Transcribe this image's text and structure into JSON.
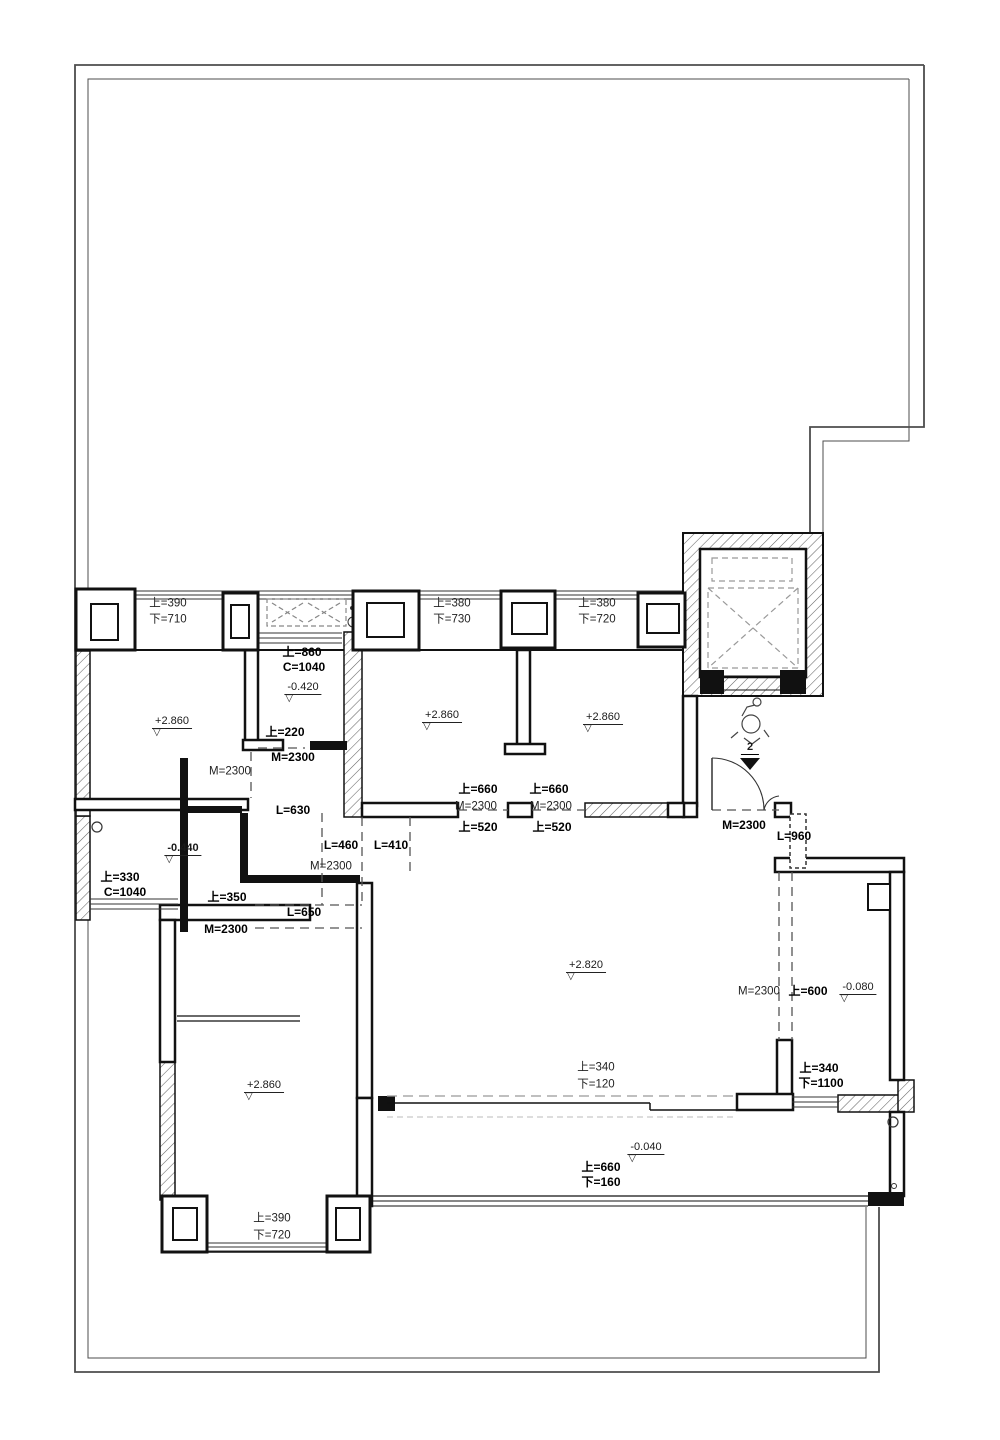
{
  "title": "apartment-floor-plan",
  "colors": {
    "line": "#1a1a1a",
    "boundary": "#4d4d4d",
    "hatch": "#666",
    "dash": "#888"
  },
  "labels": {
    "w1a": "上=390",
    "w1b": "下=710",
    "w2a": "上=380",
    "w2b": "下=730",
    "w3a": "上=380",
    "w3b": "下=720",
    "bath_top_a": "上=860",
    "bath_top_b": "C=1040",
    "bath_elev": "-0.420",
    "bedA_elev": "+2.860",
    "bedA_door": "M=2300",
    "bath_mid": "上=220",
    "bath_door": "M=2300",
    "bedB_elev": "+2.860",
    "bedC_elev": "+2.860",
    "l630": "L=630",
    "l460": "L=460",
    "l410": "L=410",
    "hall_m": "M=2300",
    "cdoor_a": "上=660",
    "cdoor_m": "M=2300",
    "cdoor_b": "上=520",
    "ddoor_a": "上=660",
    "ddoor_m": "M=2300",
    "ddoor_b": "上=520",
    "entry_m": "M=2300",
    "entry_l": "L=960",
    "store_elev": "-0.440",
    "store_win_a": "上=330",
    "store_win_b": "C=1040",
    "store_door": "上=350",
    "store_m": "M=2300",
    "l650": "L=650",
    "living_elev": "+2.820",
    "foyer_m": "M=2300",
    "foyer_door": "上=600",
    "foyer_elev": "-0.080",
    "balcwin_a": "上=340",
    "balcwin_b": "下=120",
    "foyerwin_a": "上=340",
    "foyerwin_b": "下=1100",
    "balc_elev": "-0.040",
    "balcdoor_a": "上=660",
    "balcdoor_b": "下=160",
    "bedD_elev": "+2.860",
    "w4a": "上=390",
    "w4b": "下=720",
    "section_no": "2"
  }
}
